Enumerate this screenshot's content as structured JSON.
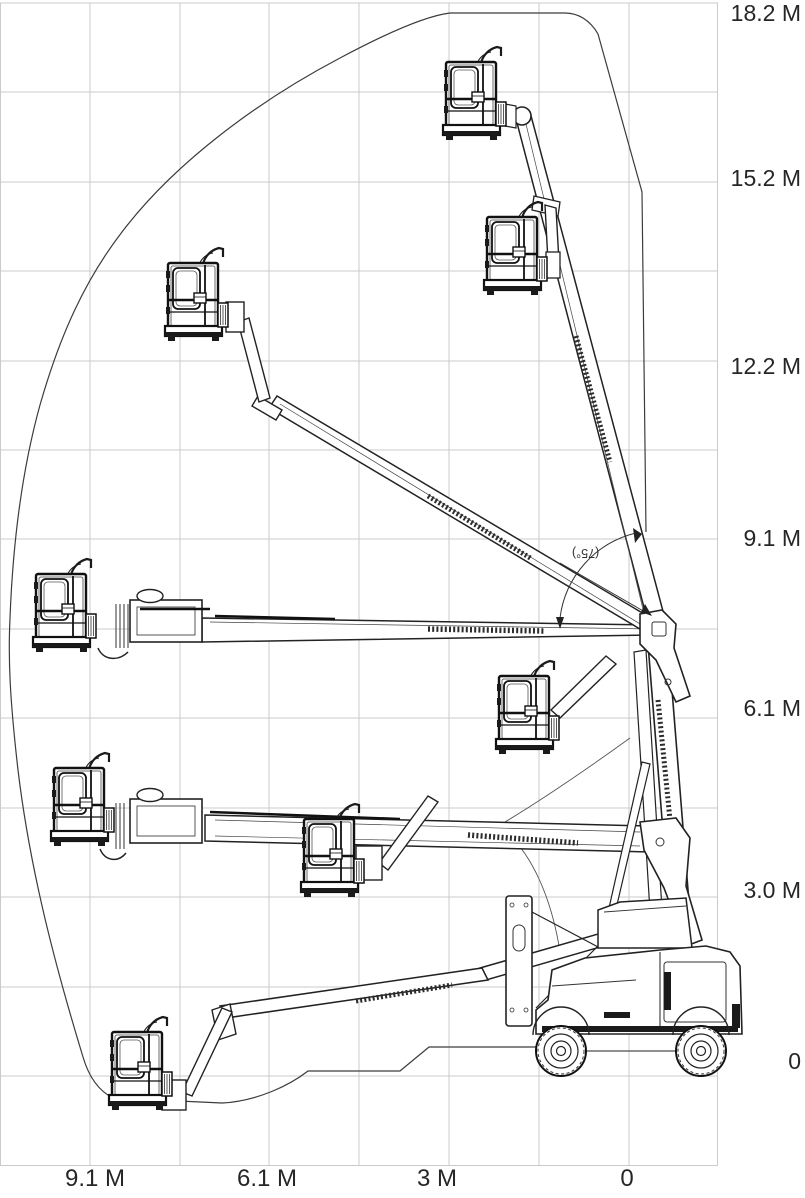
{
  "diagram": {
    "type": "boom-lift-working-envelope",
    "subject": "articulating boom lift side view with eight platform positions inside reach envelope"
  },
  "colors": {
    "background": "#ffffff",
    "grid": "#cbcbcb",
    "line": "#1a1a1a",
    "envelope": "#3c3c3c",
    "label": "#262626"
  },
  "axis": {
    "right_labels": [
      "18.2 M",
      "15.2 M",
      "12.2 M",
      "9.1 M",
      "6.1 M",
      "3.0 M",
      "0"
    ],
    "bottom_labels": [
      "9.1 M",
      "6.1 M",
      "3 M",
      "0"
    ]
  },
  "annotation": {
    "boom_angle": "(75°)"
  }
}
